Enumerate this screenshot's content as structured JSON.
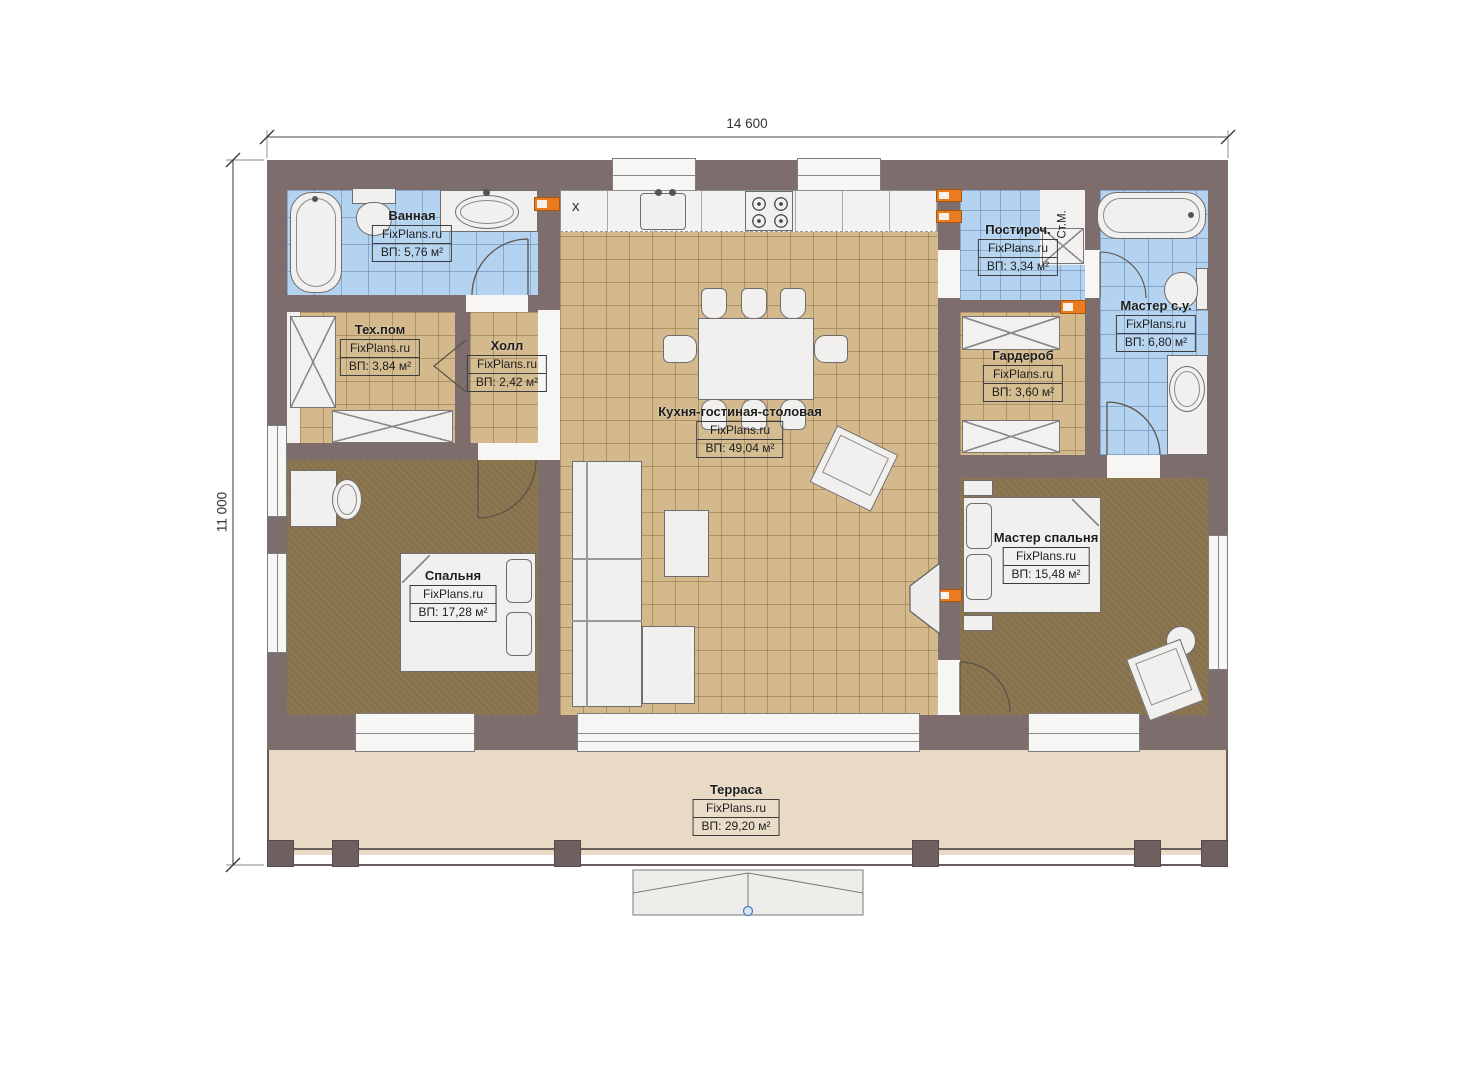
{
  "dimensions": {
    "width": "14 600",
    "height": "11 000"
  },
  "rooms": [
    {
      "key": "bathroom",
      "name": "Ванная",
      "watermark": "FixPlans.ru",
      "area": "ВП: 5,76 м²"
    },
    {
      "key": "tech",
      "name": "Тех.пом",
      "watermark": "FixPlans.ru",
      "area": "ВП: 3,84 м²"
    },
    {
      "key": "hall",
      "name": "Холл",
      "watermark": "FixPlans.ru",
      "area": "ВП: 2,42 м²"
    },
    {
      "key": "kitchen_living",
      "name": "Кухня-гостиная-столовая",
      "watermark": "FixPlans.ru",
      "area": "ВП: 49,04 м²"
    },
    {
      "key": "laundry",
      "name": "Постироч.",
      "watermark": "FixPlans.ru",
      "area": "ВП: 3,34 м²"
    },
    {
      "key": "master_bath",
      "name": "Мастер с.у.",
      "watermark": "FixPlans.ru",
      "area": "ВП: 6,80 м²"
    },
    {
      "key": "wardrobe",
      "name": "Гардероб",
      "watermark": "FixPlans.ru",
      "area": "ВП: 3,60 м²"
    },
    {
      "key": "bedroom",
      "name": "Спальня",
      "watermark": "FixPlans.ru",
      "area": "ВП: 17,28 м²"
    },
    {
      "key": "master_bedroom",
      "name": "Мастер спальня",
      "watermark": "FixPlans.ru",
      "area": "ВП: 15,48 м²"
    },
    {
      "key": "terrace",
      "name": "Терраса",
      "watermark": "FixPlans.ru",
      "area": "ВП: 29,20 м²"
    }
  ],
  "annotations": {
    "washing_machine": "Ст.М.",
    "appliance_mark": "x"
  },
  "colors": {
    "wall": "#7d6d6d",
    "tile_tan": "#d3b98c",
    "tile_blue": "#b4d3f0",
    "carpet": "#8c7751",
    "terrace": "#e8dac5",
    "accent_orange": "#ea7c1f",
    "marker_blue": "#4a7fc1"
  }
}
